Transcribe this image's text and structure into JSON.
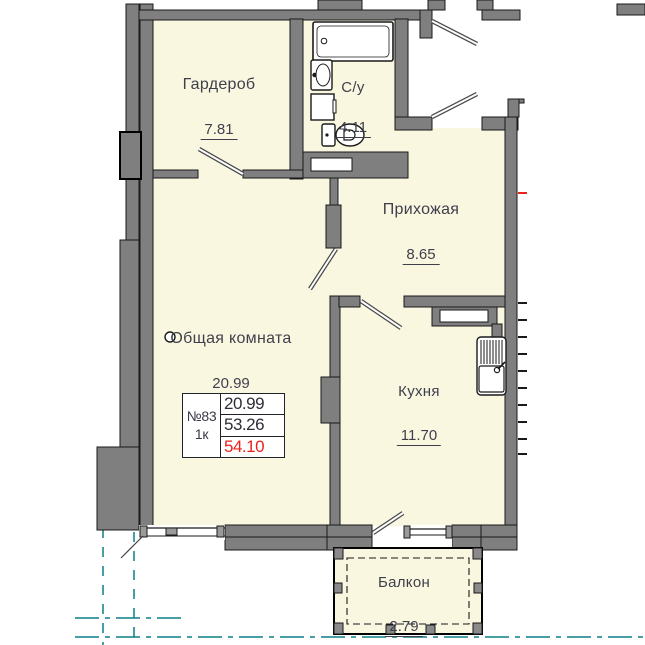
{
  "unit": {
    "number": "№83",
    "rooms_count": "1к",
    "living_area": "20.99",
    "area_without_balcony": "53.26",
    "total_area": "54.10"
  },
  "rooms": [
    {
      "id": "garderob",
      "label": "Гардероб",
      "area": "7.81"
    },
    {
      "id": "bathroom",
      "label": "С/у",
      "area": "4.11"
    },
    {
      "id": "hall",
      "label": "Прихожая",
      "area": "8.65"
    },
    {
      "id": "living",
      "label": "Общая комната",
      "area": "20.99"
    },
    {
      "id": "kitchen",
      "label": "Кухня",
      "area": "11.70"
    },
    {
      "id": "balcony",
      "label": "Балкон",
      "area": "2.79"
    }
  ],
  "colors": {
    "room_fill": "#faf7e1",
    "wall": "#7f7f7f",
    "axis_teal": "#0c7e87",
    "highlight_red": "#e8241c",
    "text": "#3f3f4c"
  }
}
